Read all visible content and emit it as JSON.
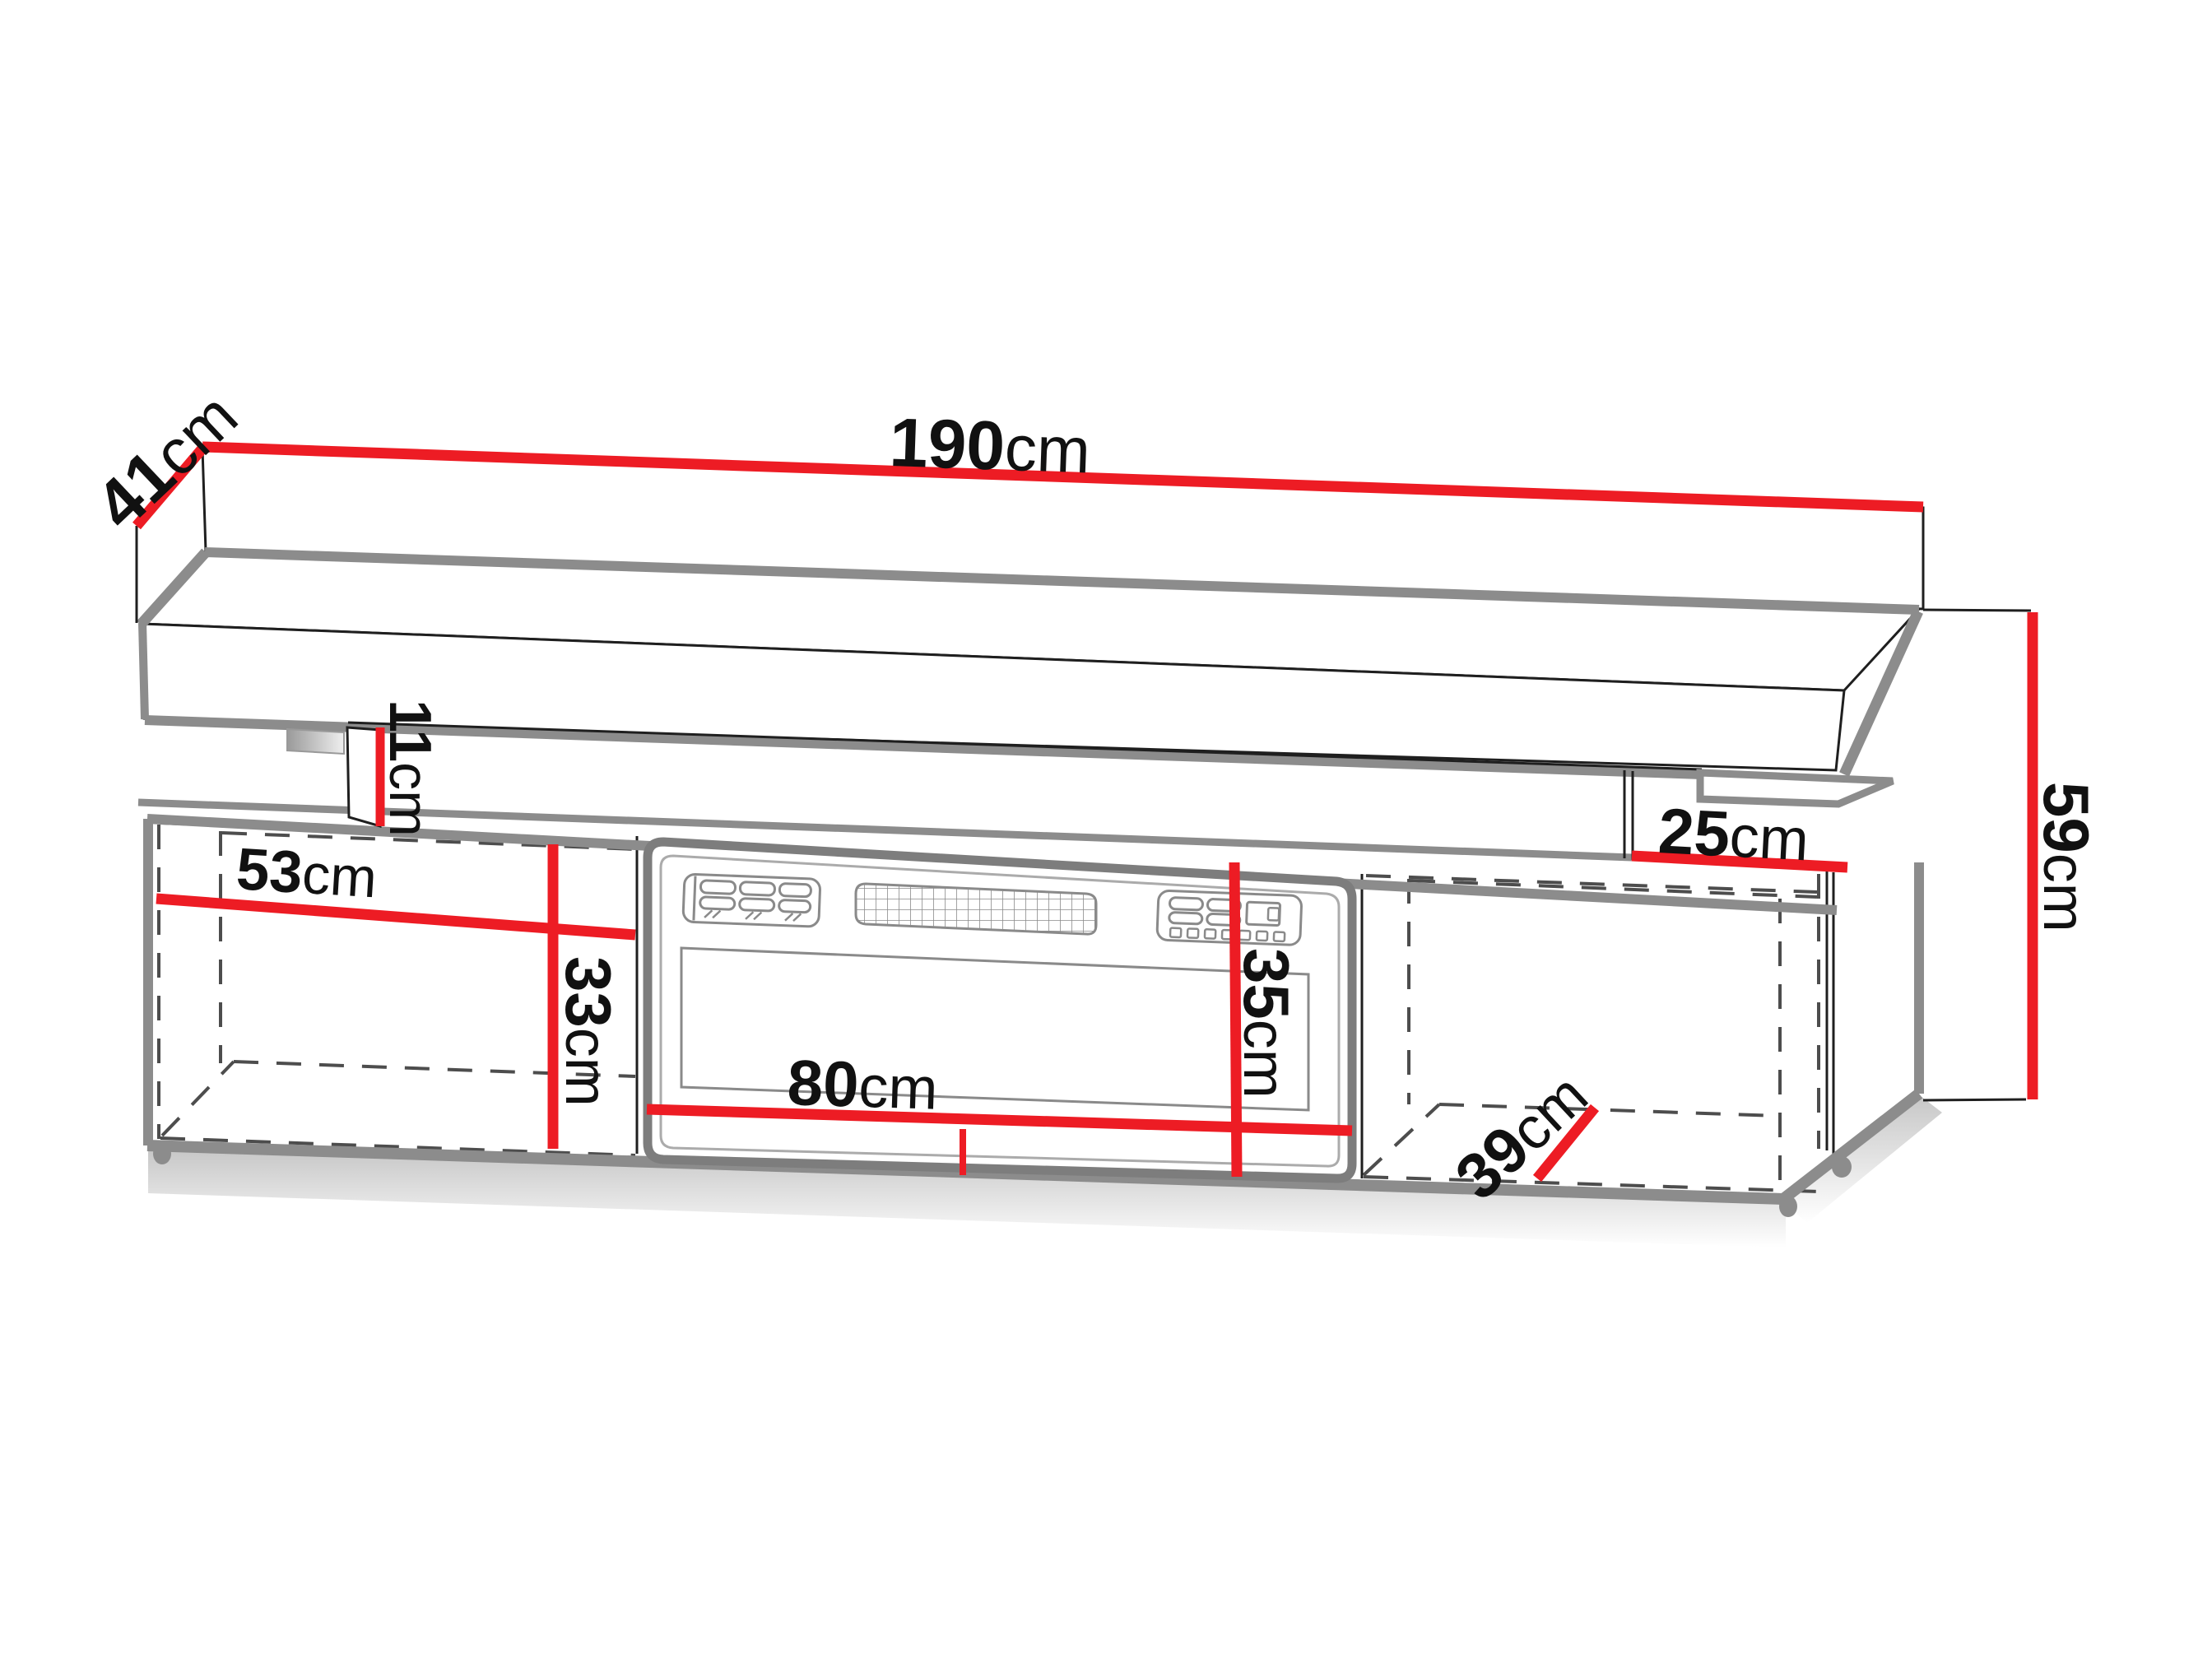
{
  "diagram": {
    "type": "furniture-dimension-drawing",
    "subject": "TV stand with electric fireplace insert and floating top shelf",
    "colors": {
      "dimension_line": "#ed1c24",
      "edge_shadow_gray": "#8c8c8c",
      "edge_thin_black": "#1f1f1f",
      "interior_dashed": "#4d4d4d",
      "background": "#ffffff"
    },
    "dims": {
      "w190": {
        "value": "190",
        "unit": "cm",
        "meaning": "total width"
      },
      "d41": {
        "value": "41",
        "unit": "cm",
        "meaning": "top shelf depth"
      },
      "h11": {
        "value": "11",
        "unit": "cm",
        "meaning": "gap between shelf and base"
      },
      "w53": {
        "value": "53",
        "unit": "cm",
        "meaning": "left compartment width"
      },
      "h33": {
        "value": "33",
        "unit": "cm",
        "meaning": "left compartment height"
      },
      "w80": {
        "value": "80",
        "unit": "cm",
        "meaning": "fireplace width"
      },
      "h35": {
        "value": "35",
        "unit": "cm",
        "meaning": "fireplace height"
      },
      "w25": {
        "value": "25",
        "unit": "cm",
        "meaning": "right top clearance"
      },
      "d39": {
        "value": "39",
        "unit": "cm",
        "meaning": "right compartment depth"
      },
      "h59": {
        "value": "59",
        "unit": "cm",
        "meaning": "total height"
      }
    }
  }
}
